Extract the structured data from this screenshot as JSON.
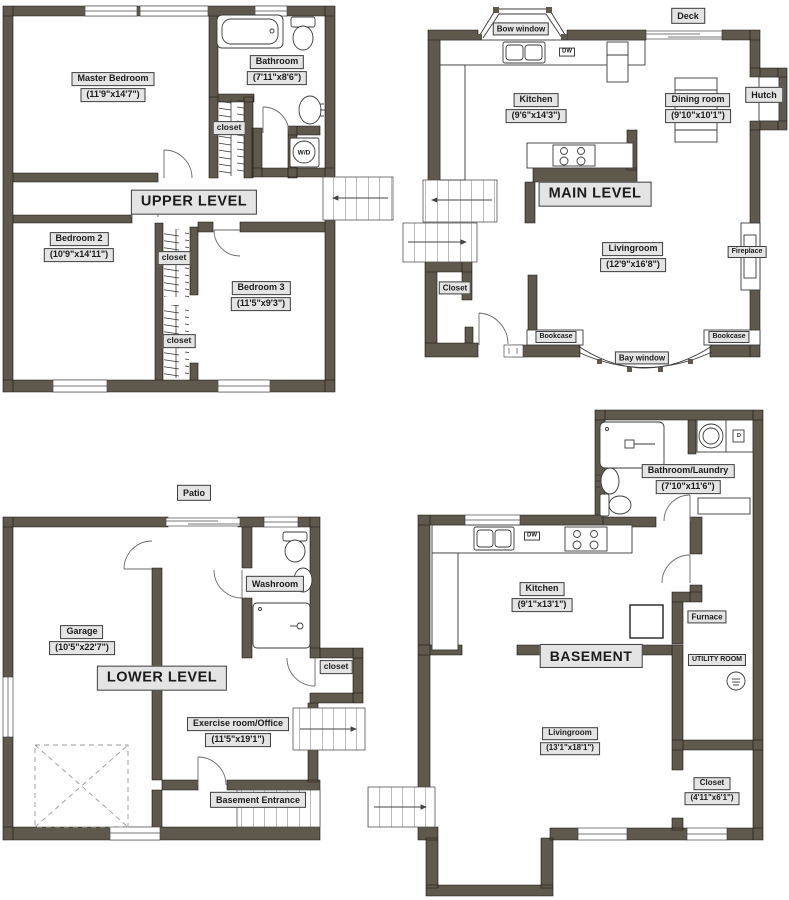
{
  "colors": {
    "wall": "#5f584d",
    "label_bg": "#e4e4e4",
    "label_border": "#3f3f3f",
    "text": "#1b1b1b"
  },
  "levels": {
    "upper": {
      "title": "UPPER LEVEL",
      "master_bedroom": {
        "name": "Master Bedroom",
        "dims": "(11'9\"x14'7\")"
      },
      "bathroom": {
        "name": "Bathroom",
        "dims": "(7'11\"x8'6\")"
      },
      "bedroom2": {
        "name": "Bedroom 2",
        "dims": "(10'9\"x14'11\")"
      },
      "bedroom3": {
        "name": "Bedroom 3",
        "dims": "(11'5\"x9'3\")"
      },
      "closet1": "closet",
      "closet2": "closet",
      "closet3": "closet",
      "washer_dryer": "W/D"
    },
    "main": {
      "title": "MAIN LEVEL",
      "kitchen": {
        "name": "Kitchen",
        "dims": "(9'6\"x14'3\")"
      },
      "dining_room": {
        "name": "Dining room",
        "dims": "(9'10\"x10'1\")"
      },
      "livingroom": {
        "name": "Livingroom",
        "dims": "(12'9\"x16'8\")"
      },
      "closet": "Closet",
      "bow_window": "Bow window",
      "bay_window": "Bay window",
      "deck": "Deck",
      "hutch": "Hutch",
      "fireplace": "Fireplace",
      "bookcase_left": "Bookcase",
      "bookcase_right": "Bookcase",
      "dishwasher": "DW"
    },
    "lower": {
      "title": "LOWER LEVEL",
      "patio": "Patio",
      "garage": {
        "name": "Garage",
        "dims": "(10'5\"x22'7\")"
      },
      "exercise_room": {
        "name": "Exercise room/Office",
        "dims": "(11'5\"x19'1\")"
      },
      "washroom": "Washroom",
      "closet": "closet",
      "basement_entrance": "Basement Entrance"
    },
    "basement": {
      "title": "BASEMENT",
      "bathroom_laundry": {
        "name": "Bathroom/Laundry",
        "dims": "(7'10\"x11'6\")"
      },
      "kitchen": {
        "name": "Kitchen",
        "dims": "(9'1\"x13'1\")"
      },
      "livingroom": {
        "name": "Livingroom",
        "dims": "(13'1\"x18'1\")"
      },
      "closet": {
        "name": "Closet",
        "dims": "(4'11\"x6'1\")"
      },
      "furnace": "Furnace",
      "utility_room": "UTILITY ROOM",
      "dishwasher": "DW",
      "dryer": "D"
    }
  }
}
